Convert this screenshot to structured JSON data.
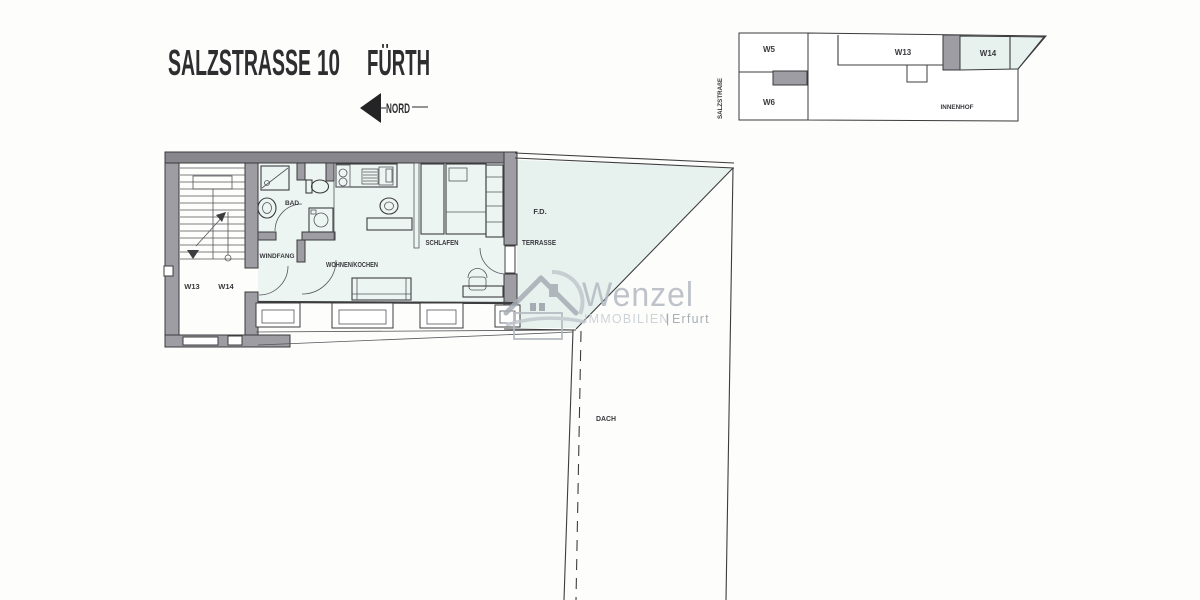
{
  "title": {
    "street": "SALZSTRASSE",
    "number": "10",
    "city": "FÜRTH"
  },
  "north": {
    "label": "NORD"
  },
  "site_plan": {
    "street_label": "SALZSTRAßE",
    "unit_w5": "W5",
    "unit_w6": "W6",
    "unit_w13": "W13",
    "unit_w14": "W14",
    "courtyard": "INNENHOF"
  },
  "floor_plan": {
    "unit_left": "W13",
    "unit_right": "W14",
    "bad": "BAD",
    "windfang": "WINDFANG",
    "wohnen_kochen": "WOHNEN/KOCHEN",
    "schlafen": "SCHLAFEN",
    "fd": "F.D.",
    "terrasse": "TERRASSE",
    "dach": "DACH"
  },
  "logo": {
    "brand": "Wenzel",
    "subtitle": "IMMOBILIEN",
    "divider": "|",
    "location": "Erfurt"
  },
  "colors": {
    "wall": "#9d9da3",
    "wall_dark": "#87878d",
    "tint": "#e7f1ee",
    "tint_light": "#edf5f2",
    "line": "#3d3d3f",
    "logo_gray": "#a6adb4",
    "logo_light": "#c2c8ce",
    "logo_text": "#b3bac1"
  }
}
